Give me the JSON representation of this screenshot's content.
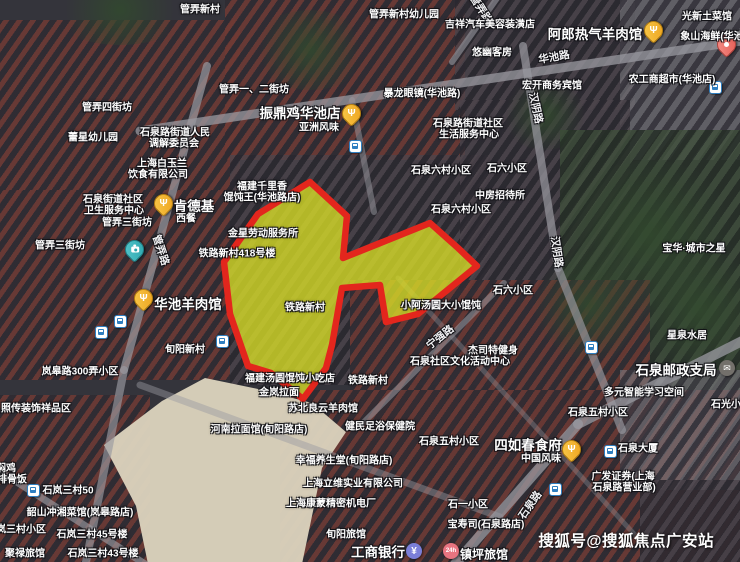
{
  "map": {
    "watermark": "搜狐号@搜狐焦点广安站",
    "colors": {
      "highlight_fill": "#dadf26",
      "highlight_border": "#e3261d",
      "food_pin_yellow": "#eea41f",
      "seafood_pin_red": "#e55d55",
      "camera_pin_teal": "#2da6ae",
      "bus_icon_blue": "#2f7fc1",
      "bank_icon_purple": "#7b7fd8",
      "hotel_icon_pink": "#e87480"
    },
    "highlight": {
      "points": "310,182 347,216 343,258 430,223 458,248 477,266 418,314 386,322 380,285 342,288 332,345 326,368 303,399 271,373 248,366 230,314 224,262 258,214",
      "fill": "#dadf26",
      "fill_opacity": "0.78",
      "stroke": "#e3261d",
      "stroke_width": "6.5"
    },
    "labels": [
      {
        "text": "管弄新村",
        "x": 200,
        "y": 8,
        "s": "sm"
      },
      {
        "text": "管弄新村幼儿园",
        "x": 404,
        "y": 13,
        "s": "sm"
      },
      {
        "text": "管弄路",
        "x": 481,
        "y": 9,
        "s": "road",
        "r": 58
      },
      {
        "text": "光新土菜馆",
        "x": 707,
        "y": 15,
        "s": "sm"
      },
      {
        "text": "吉祥汽车美容装潢店",
        "x": 490,
        "y": 23,
        "s": "sm"
      },
      {
        "text": "阿郎热气羊肉馆",
        "x": 595,
        "y": 33,
        "s": "lg"
      },
      {
        "text": "象山海鲜(华池",
        "x": 712,
        "y": 35,
        "s": "sm"
      },
      {
        "text": "悠幽客房",
        "x": 492,
        "y": 51,
        "s": "sm"
      },
      {
        "text": "华池路",
        "x": 554,
        "y": 57,
        "s": "road",
        "r": -10
      },
      {
        "text": "农工商超市(华池店)",
        "x": 672,
        "y": 78,
        "s": "sm"
      },
      {
        "text": "宏开商务宾馆",
        "x": 552,
        "y": 84,
        "s": "sm"
      },
      {
        "text": "管弄一、二街坊",
        "x": 254,
        "y": 88,
        "s": "sm"
      },
      {
        "text": "暴龙眼镜(华池路)",
        "x": 422,
        "y": 92,
        "s": "sm"
      },
      {
        "text": "管弄四街坊",
        "x": 107,
        "y": 106,
        "s": "sm"
      },
      {
        "text": "汉阴路",
        "x": 536,
        "y": 108,
        "s": "road",
        "r": 78
      },
      {
        "text": "振鼎鸡华池店",
        "x": 300,
        "y": 112,
        "s": "lg"
      },
      {
        "text": "石泉路街道社区",
        "x": 468,
        "y": 122,
        "s": "sm"
      },
      {
        "text": "亚洲风味",
        "x": 319,
        "y": 126,
        "s": "sm"
      },
      {
        "text": "石泉路街道人民",
        "x": 175,
        "y": 131,
        "s": "sm"
      },
      {
        "text": "生活服务中心",
        "x": 469,
        "y": 133,
        "s": "sm"
      },
      {
        "text": "蕾星幼儿园",
        "x": 93,
        "y": 136,
        "s": "sm"
      },
      {
        "text": "调解委员会",
        "x": 174,
        "y": 142,
        "s": "sm"
      },
      {
        "text": "上海白玉兰",
        "x": 162,
        "y": 162,
        "s": "sm"
      },
      {
        "text": "石泉六村小区",
        "x": 441,
        "y": 169,
        "s": "sm"
      },
      {
        "text": "石六小区",
        "x": 507,
        "y": 167,
        "s": "sm"
      },
      {
        "text": "饮食有限公司",
        "x": 158,
        "y": 173,
        "s": "sm"
      },
      {
        "text": "福建千里香",
        "x": 262,
        "y": 185,
        "s": "sm"
      },
      {
        "text": "馄饨王(华池路店)",
        "x": 262,
        "y": 196,
        "s": "sm"
      },
      {
        "text": "石泉街道社区",
        "x": 113,
        "y": 198,
        "s": "sm"
      },
      {
        "text": "中房招待所",
        "x": 500,
        "y": 194,
        "s": "sm"
      },
      {
        "text": "肯德基",
        "x": 194,
        "y": 205,
        "s": "lg"
      },
      {
        "text": "卫生服务中心",
        "x": 114,
        "y": 209,
        "s": "sm"
      },
      {
        "text": "石泉六村小区",
        "x": 461,
        "y": 208,
        "s": "sm"
      },
      {
        "text": "西餐",
        "x": 186,
        "y": 217,
        "s": "sm"
      },
      {
        "text": "管弄三街坊",
        "x": 127,
        "y": 221,
        "s": "sm"
      },
      {
        "text": "金星劳动服务所",
        "x": 263,
        "y": 232,
        "s": "sm"
      },
      {
        "text": "管弄三街坊",
        "x": 60,
        "y": 244,
        "s": "sm"
      },
      {
        "text": "铁路新村418号楼",
        "x": 237,
        "y": 252,
        "s": "sm"
      },
      {
        "text": "管弄路",
        "x": 161,
        "y": 250,
        "s": "road",
        "r": 72
      },
      {
        "text": "宝华·城市之星",
        "x": 694,
        "y": 247,
        "s": "sm"
      },
      {
        "text": "汉阴路",
        "x": 557,
        "y": 252,
        "s": "road",
        "r": 82
      },
      {
        "text": "石六小区",
        "x": 513,
        "y": 289,
        "s": "sm"
      },
      {
        "text": "华池羊肉馆",
        "x": 188,
        "y": 303,
        "s": "lg"
      },
      {
        "text": "小阿汤圆大小馄饨",
        "x": 441,
        "y": 304,
        "s": "sm"
      },
      {
        "text": "铁路新村",
        "x": 305,
        "y": 306,
        "s": "sm"
      },
      {
        "text": "星泉水居",
        "x": 687,
        "y": 334,
        "s": "sm"
      },
      {
        "text": "宁强路",
        "x": 440,
        "y": 337,
        "s": "road",
        "r": -38
      },
      {
        "text": "旬阳新村",
        "x": 185,
        "y": 348,
        "s": "sm"
      },
      {
        "text": "杰司特健身",
        "x": 493,
        "y": 349,
        "s": "sm"
      },
      {
        "text": "石泉社区文化活动中心",
        "x": 460,
        "y": 360,
        "s": "sm"
      },
      {
        "text": "石泉邮政支局",
        "x": 676,
        "y": 369,
        "s": "lg"
      },
      {
        "text": "岚皋路300弄小区",
        "x": 80,
        "y": 370,
        "s": "sm"
      },
      {
        "text": "福建汤圆馄饨小吃店",
        "x": 290,
        "y": 377,
        "s": "sm"
      },
      {
        "text": "铁路新村",
        "x": 368,
        "y": 379,
        "s": "sm"
      },
      {
        "text": "金岚拉面",
        "x": 279,
        "y": 391,
        "s": "sm"
      },
      {
        "text": "多元智能学习空间",
        "x": 644,
        "y": 391,
        "s": "sm"
      },
      {
        "text": "石光小区",
        "x": 731,
        "y": 403,
        "s": "sm"
      },
      {
        "text": "照传装饰祥品区",
        "x": 36,
        "y": 407,
        "s": "sm"
      },
      {
        "text": "苏北良云羊肉馆",
        "x": 323,
        "y": 407,
        "s": "sm"
      },
      {
        "text": "石泉五村小区",
        "x": 598,
        "y": 411,
        "s": "sm"
      },
      {
        "text": "健民足浴保健院",
        "x": 380,
        "y": 425,
        "s": "sm"
      },
      {
        "text": "河南拉面馆(旬阳路店)",
        "x": 259,
        "y": 428,
        "s": "sm"
      },
      {
        "text": "石泉五村小区",
        "x": 449,
        "y": 440,
        "s": "sm"
      },
      {
        "text": "四如春食府",
        "x": 528,
        "y": 444,
        "s": "lg"
      },
      {
        "text": "石泉大厦",
        "x": 638,
        "y": 447,
        "s": "sm"
      },
      {
        "text": "中国风味",
        "x": 541,
        "y": 457,
        "s": "sm"
      },
      {
        "text": "幸福养生堂(旬阳路店)",
        "x": 344,
        "y": 459,
        "s": "sm"
      },
      {
        "text": "焖鸡",
        "x": 6,
        "y": 467,
        "s": "sm"
      },
      {
        "text": "广发证券(上海",
        "x": 623,
        "y": 475,
        "s": "sm"
      },
      {
        "text": "排骨饭",
        "x": 12,
        "y": 478,
        "s": "sm"
      },
      {
        "text": "上海立维实业有限公司",
        "x": 353,
        "y": 482,
        "s": "sm"
      },
      {
        "text": "石泉路营业部)",
        "x": 624,
        "y": 486,
        "s": "sm"
      },
      {
        "text": "石岚三村50",
        "x": 68,
        "y": 489,
        "s": "sm"
      },
      {
        "text": "上海康蒙精密机电厂",
        "x": 331,
        "y": 502,
        "s": "sm"
      },
      {
        "text": "石一小区",
        "x": 468,
        "y": 503,
        "s": "sm"
      },
      {
        "text": "石泉路",
        "x": 530,
        "y": 505,
        "s": "road",
        "r": -55
      },
      {
        "text": "韶山冲湘菜馆(岚皋路店)",
        "x": 80,
        "y": 511,
        "s": "sm"
      },
      {
        "text": "宝寿司(石泉路店)",
        "x": 486,
        "y": 523,
        "s": "sm"
      },
      {
        "text": "石岚三村小区",
        "x": 16,
        "y": 528,
        "s": "sm"
      },
      {
        "text": "石岚三村45号楼",
        "x": 92,
        "y": 533,
        "s": "sm"
      },
      {
        "text": "旬阳旅馆",
        "x": 346,
        "y": 533,
        "s": "sm"
      },
      {
        "text": "聚禄旅馆",
        "x": 25,
        "y": 552,
        "s": "sm"
      },
      {
        "text": "石岚三村43号楼",
        "x": 103,
        "y": 552,
        "s": "sm"
      },
      {
        "text": "工商银行",
        "x": 378,
        "y": 551,
        "s": "lg"
      },
      {
        "text": "镇坪旅馆",
        "x": 484,
        "y": 554,
        "s": "md"
      }
    ],
    "markers": [
      {
        "type": "food-pin",
        "x": 350,
        "y": 113
      },
      {
        "type": "food-pin",
        "x": 652,
        "y": 30
      },
      {
        "type": "food-pin",
        "x": 162,
        "y": 203
      },
      {
        "type": "food-pin",
        "x": 142,
        "y": 298
      },
      {
        "type": "food-pin",
        "x": 570,
        "y": 449
      },
      {
        "type": "seafood-pin",
        "x": 725,
        "y": 44
      },
      {
        "type": "camera-pin",
        "x": 133,
        "y": 249
      },
      {
        "type": "bus-stop",
        "x": 355,
        "y": 146
      },
      {
        "type": "bus-stop",
        "x": 715,
        "y": 87
      },
      {
        "type": "bus-stop",
        "x": 120,
        "y": 321
      },
      {
        "type": "bus-stop",
        "x": 101,
        "y": 332
      },
      {
        "type": "bus-stop",
        "x": 222,
        "y": 341
      },
      {
        "type": "bus-stop",
        "x": 591,
        "y": 347
      },
      {
        "type": "bus-stop",
        "x": 33,
        "y": 490
      },
      {
        "type": "bus-stop",
        "x": 610,
        "y": 451
      },
      {
        "type": "bus-stop",
        "x": 555,
        "y": 489
      },
      {
        "type": "post-office",
        "x": 727,
        "y": 368
      },
      {
        "type": "bank",
        "x": 414,
        "y": 551
      },
      {
        "type": "hotel-24h",
        "x": 451,
        "y": 551
      }
    ]
  }
}
